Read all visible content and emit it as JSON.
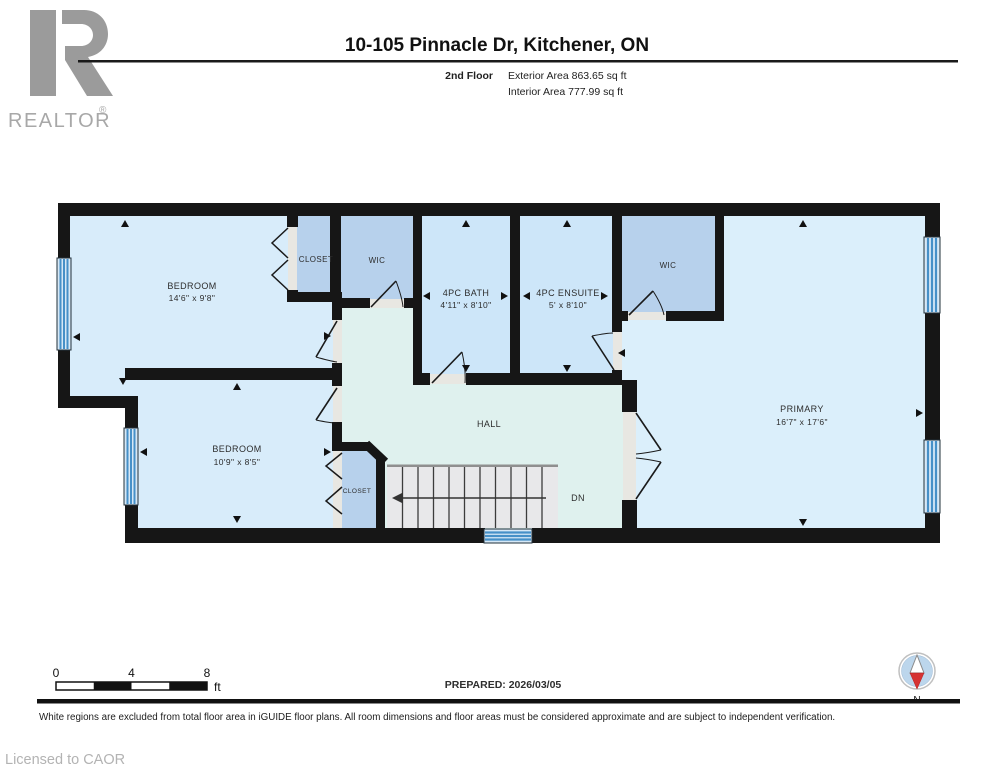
{
  "header": {
    "logo_letter": "R",
    "logo_brand": "REALTOR",
    "logo_registered": "®",
    "title": "10-105 Pinnacle Dr, Kitchener, ON",
    "floor_label": "2nd Floor",
    "exterior_area": "Exterior Area 863.65 sq ft",
    "interior_area": "Interior Area 777.99 sq ft"
  },
  "floorplan": {
    "rooms": {
      "bedroom1": {
        "label": "BEDROOM",
        "dims": "14'6\" x 9'8\""
      },
      "closet1": {
        "label": "CLOSET"
      },
      "wic1": {
        "label": "WIC"
      },
      "bath": {
        "label": "4PC BATH",
        "dims": "4'11\" x 8'10\""
      },
      "ensuite": {
        "label": "4PC ENSUITE",
        "dims": "5' x 8'10\""
      },
      "wic2": {
        "label": "WIC"
      },
      "primary": {
        "label": "PRIMARY",
        "dims": "16'7\" x 17'6\""
      },
      "bedroom2": {
        "label": "BEDROOM",
        "dims": "10'9\" x 8'5\""
      },
      "hall": {
        "label": "HALL"
      },
      "closet2": {
        "label": "CLOSET"
      },
      "stairs": {
        "label": "DN"
      }
    }
  },
  "footer": {
    "scale_ticks": [
      "0",
      "4",
      "8"
    ],
    "scale_unit": "ft",
    "prepared": "PREPARED: 2026/03/05",
    "compass_label": "N",
    "disclaimer": "White regions are excluded from total floor area in iGUIDE floor plans. All room dimensions and floor areas must be considered approximate and are subject to independent verification.",
    "license": "Licensed to CAOR"
  },
  "colors": {
    "room_blue": "#d8ecfa",
    "bath_blue": "#cde6f9",
    "closet_blue": "#b7d1ec",
    "hall_teal": "#dff1ee",
    "wall_black": "#161616",
    "window_blue": "#4690c8",
    "logo_gray": "#9b9b9b",
    "compass_red": "#d63333"
  }
}
